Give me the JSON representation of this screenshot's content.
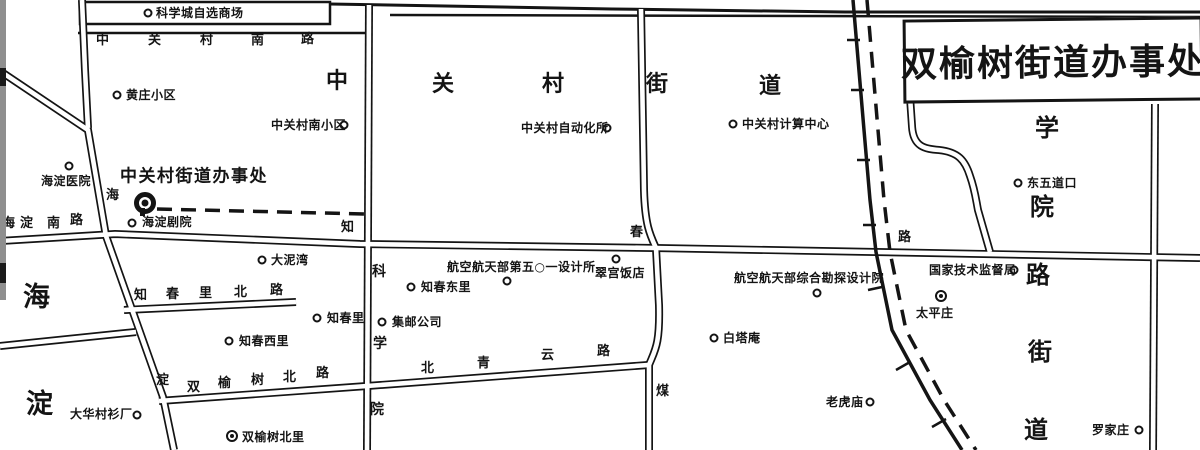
{
  "title_box": {
    "text": "双榆树街道办事处"
  },
  "colors": {
    "ink": "#141414",
    "paper": "#ffffff",
    "edge_strip": "#8f8f8f"
  },
  "block": {
    "name": "kexuecheng-block",
    "x": 80,
    "y": 2,
    "w": 250,
    "h": 22
  },
  "roads": [
    {
      "name": "top-boundary-road",
      "kind": "single",
      "w": 3,
      "d": "M330,4 L612,9 L845,12 L1200,12"
    },
    {
      "name": "top-road-south-edge",
      "kind": "single",
      "w": 2.5,
      "d": "M390,15 L1200,17"
    },
    {
      "name": "zhongguancun-south-road-line",
      "kind": "single",
      "w": 2.5,
      "d": "M78,33 L372,33"
    },
    {
      "name": "haidian-south-zhichun-road",
      "kind": "double",
      "d": "M0,241 L115,234 L360,244 L655,248 L876,252 L1200,258"
    },
    {
      "name": "haidian-road-diagonal",
      "kind": "double",
      "d": "M0,71 L88,130 L106,236 L163,397 L174,450"
    },
    {
      "name": "north-vertical-stub",
      "kind": "double",
      "d": "M82,0 L85,70 L88,128"
    },
    {
      "name": "keyuan-vertical-road",
      "kind": "double",
      "d": "M369,5 L367,450"
    },
    {
      "name": "central-vertical-road",
      "kind": "double",
      "d": "M641,9 L644,190 C645,225 650,235 656,248 L659,305 C660,345 655,350 649,365 L649,450"
    },
    {
      "name": "zhichunli-north-road",
      "kind": "double",
      "d": "M124,310 L296,302"
    },
    {
      "name": "west-stub-road",
      "kind": "double",
      "d": "M0,346 L136,332"
    },
    {
      "name": "shuangyushu-beiqingyun-road",
      "kind": "double",
      "d": "M159,401 L367,386 L648,365"
    },
    {
      "name": "scurve-road",
      "kind": "double",
      "d": "M910,97 L912,126 C913,147 925,149 939,150 C958,152 965,160 970,176 C975,190 976,200 978,210 L990,252"
    },
    {
      "name": "east-vertical-road",
      "kind": "double",
      "d": "M1155,104 L1153,450"
    }
  ],
  "railway": {
    "solid": "M853,0 L864,130 L870,200 L876,252 L892,330 L930,400 L962,450",
    "dashed": "M867,0 L878,130 L884,200 L890,252 L906,330 L944,400 L976,450",
    "ticks": "M847,40 L860,40 M851,90 L864,90 M857,160 L870,160 M863,225 L876,225 M868,290 L882,287 M896,370 L910,362 M932,427 L946,419",
    "dash": "16 10"
  },
  "boundary": {
    "d": "M157,209 L365,214",
    "dash": "15 9"
  },
  "edge_marks": [
    {
      "y": 68,
      "h": 18
    },
    {
      "y": 263,
      "h": 20
    }
  ],
  "area_labels": [
    {
      "name": "zhongguancun-subdistrict-label",
      "size": 22,
      "chars": [
        {
          "c": "中",
          "x": 326,
          "y": 71
        },
        {
          "c": "关",
          "x": 432,
          "y": 74
        },
        {
          "c": "村",
          "x": 542,
          "y": 74
        },
        {
          "c": "街",
          "x": 646,
          "y": 74
        },
        {
          "c": "道",
          "x": 759,
          "y": 76
        }
      ]
    },
    {
      "name": "xueyuanlu-subdistrict-label",
      "size": 24,
      "chars": [
        {
          "c": "学",
          "x": 1035,
          "y": 116
        },
        {
          "c": "院",
          "x": 1030,
          "y": 195
        },
        {
          "c": "路",
          "x": 1026,
          "y": 263
        },
        {
          "c": "街",
          "x": 1028,
          "y": 340
        },
        {
          "c": "道",
          "x": 1024,
          "y": 418
        }
      ]
    },
    {
      "name": "haidian-area-label",
      "size": 27,
      "chars": [
        {
          "c": "海",
          "x": 23,
          "y": 284
        },
        {
          "c": "淀",
          "x": 26,
          "y": 391
        }
      ]
    }
  ],
  "road_labels": [
    {
      "name": "zhongguancun-south-road-label",
      "size": 13,
      "chars": [
        {
          "c": "中",
          "x": 96,
          "y": 34
        },
        {
          "c": "关",
          "x": 148,
          "y": 34
        },
        {
          "c": "村",
          "x": 200,
          "y": 34
        },
        {
          "c": "南",
          "x": 251,
          "y": 34
        },
        {
          "c": "路",
          "x": 301,
          "y": 33
        }
      ]
    },
    {
      "name": "haidian-south-road-label",
      "size": 13,
      "chars": [
        {
          "c": "海",
          "x": 2,
          "y": 217
        },
        {
          "c": "淀",
          "x": 20,
          "y": 217
        },
        {
          "c": "南",
          "x": 47,
          "y": 217
        },
        {
          "c": "路",
          "x": 70,
          "y": 214
        }
      ]
    },
    {
      "name": "zhichun-road-label",
      "size": 13,
      "chars": [
        {
          "c": "知",
          "x": 341,
          "y": 221
        },
        {
          "c": "春",
          "x": 630,
          "y": 226
        },
        {
          "c": "路",
          "x": 898,
          "y": 231
        }
      ]
    },
    {
      "name": "zhichunli-north-road-label",
      "size": 13,
      "chars": [
        {
          "c": "知",
          "x": 134,
          "y": 289
        },
        {
          "c": "春",
          "x": 166,
          "y": 288
        },
        {
          "c": "里",
          "x": 199,
          "y": 287
        },
        {
          "c": "北",
          "x": 234,
          "y": 286
        },
        {
          "c": "路",
          "x": 270,
          "y": 284
        }
      ]
    },
    {
      "name": "shuangyushu-north-road-label",
      "size": 13,
      "chars": [
        {
          "c": "双",
          "x": 187,
          "y": 381
        },
        {
          "c": "榆",
          "x": 218,
          "y": 377
        },
        {
          "c": "树",
          "x": 251,
          "y": 374
        },
        {
          "c": "北",
          "x": 283,
          "y": 371
        },
        {
          "c": "路",
          "x": 316,
          "y": 367
        }
      ]
    },
    {
      "name": "beiqingyun-road-label",
      "size": 13,
      "chars": [
        {
          "c": "北",
          "x": 421,
          "y": 362
        },
        {
          "c": "青",
          "x": 477,
          "y": 357
        },
        {
          "c": "云",
          "x": 541,
          "y": 349
        },
        {
          "c": "路",
          "x": 597,
          "y": 345
        }
      ]
    },
    {
      "name": "keyuan-road-label",
      "size": 14,
      "chars": [
        {
          "c": "科",
          "x": 372,
          "y": 265
        },
        {
          "c": "学",
          "x": 373,
          "y": 337
        },
        {
          "c": "院",
          "x": 370,
          "y": 403
        }
      ]
    },
    {
      "name": "haidian-road-label",
      "size": 13,
      "chars": [
        {
          "c": "海",
          "x": 106,
          "y": 189
        },
        {
          "c": "淀",
          "x": 156,
          "y": 374
        }
      ]
    },
    {
      "name": "mei-road-label",
      "size": 13,
      "chars": [
        {
          "c": "煤",
          "x": 656,
          "y": 385
        }
      ]
    }
  ],
  "pois": [
    {
      "name": "kexuecheng-store",
      "label": "科学城自选商场",
      "lx": 156,
      "ly": 13,
      "mx": 148,
      "my": 13,
      "marker": "ring"
    },
    {
      "name": "huangzhuang-xiaoqu",
      "label": "黄庄小区",
      "lx": 126,
      "ly": 95,
      "mx": 117,
      "my": 95,
      "marker": "ring"
    },
    {
      "name": "zhongguancun-south-xiaoqu",
      "label": "中关村南小区",
      "lx": 271,
      "ly": 125,
      "mx": 344,
      "my": 125,
      "marker": "ring"
    },
    {
      "name": "zhongguancun-automation-institute",
      "label": "中关村自动化所",
      "lx": 521,
      "ly": 128,
      "mx": 607,
      "my": 128,
      "marker": "ring"
    },
    {
      "name": "zhongguancun-computing-center",
      "label": "中关村计算中心",
      "lx": 742,
      "ly": 124,
      "mx": 733,
      "my": 124,
      "marker": "ring"
    },
    {
      "name": "dongwudaokou",
      "label": "东五道口",
      "lx": 1027,
      "ly": 183,
      "mx": 1018,
      "my": 183,
      "marker": "ring"
    },
    {
      "name": "haidian-hospital",
      "label": "海淀医院",
      "lx": 41,
      "ly": 181,
      "mx": 69,
      "my": 166,
      "marker": "ring"
    },
    {
      "name": "zhongguancun-subdistrict-office",
      "label": "中关村街道办事处",
      "lx": 120,
      "ly": 177,
      "mx": 145,
      "my": 203,
      "marker": "office"
    },
    {
      "name": "haidian-theater",
      "label": "海淀剧院",
      "lx": 142,
      "ly": 222,
      "mx": 132,
      "my": 223,
      "marker": "ring"
    },
    {
      "name": "daniwan",
      "label": "大泥湾",
      "lx": 271,
      "ly": 260,
      "mx": 262,
      "my": 260,
      "marker": "ring"
    },
    {
      "name": "zhichun-dongli",
      "label": "知春东里",
      "lx": 421,
      "ly": 287,
      "mx": 411,
      "my": 287,
      "marker": "ring"
    },
    {
      "name": "jiyou-gongsi",
      "label": "集邮公司",
      "lx": 392,
      "ly": 322,
      "mx": 382,
      "my": 322,
      "marker": "ring"
    },
    {
      "name": "zhichunli",
      "label": "知春里",
      "lx": 327,
      "ly": 318,
      "mx": 317,
      "my": 318,
      "marker": "ring"
    },
    {
      "name": "zhichun-xili",
      "label": "知春西里",
      "lx": 239,
      "ly": 341,
      "mx": 229,
      "my": 341,
      "marker": "ring"
    },
    {
      "name": "aerospace-501-design-institute",
      "label": "航空航天部第五○一设计所",
      "lx": 447,
      "ly": 267,
      "mx": 507,
      "my": 281,
      "marker": "ring"
    },
    {
      "name": "cuigong-hotel",
      "label": "翠宫饭店",
      "lx": 595,
      "ly": 273,
      "mx": 616,
      "my": 259,
      "marker": "ring"
    },
    {
      "name": "aerospace-survey-design-institute",
      "label": "航空航天部综合勘探设计院",
      "lx": 734,
      "ly": 278,
      "mx": 817,
      "my": 293,
      "marker": "ring"
    },
    {
      "name": "state-technical-supervision-bureau",
      "label": "国家技术监督局",
      "lx": 929,
      "ly": 270,
      "mx": 1014,
      "my": 270,
      "marker": "ring"
    },
    {
      "name": "taipingzhuang",
      "label": "太平庄",
      "lx": 916,
      "ly": 313,
      "mx": 941,
      "my": 296,
      "marker": "target"
    },
    {
      "name": "baitaan",
      "label": "白塔庵",
      "lx": 723,
      "ly": 338,
      "mx": 714,
      "my": 338,
      "marker": "ring"
    },
    {
      "name": "laohumiao",
      "label": "老虎庙",
      "lx": 826,
      "ly": 402,
      "mx": 870,
      "my": 402,
      "marker": "ring"
    },
    {
      "name": "luojiazhuang",
      "label": "罗家庄",
      "lx": 1092,
      "ly": 430,
      "mx": 1139,
      "my": 430,
      "marker": "ring"
    },
    {
      "name": "dahua-shirt-factory",
      "label": "大华村衫厂",
      "lx": 70,
      "ly": 414,
      "mx": 137,
      "my": 415,
      "marker": "ring"
    },
    {
      "name": "shuangyushu-beili",
      "label": "双榆树北里",
      "lx": 242,
      "ly": 437,
      "mx": 232,
      "my": 436,
      "marker": "target"
    }
  ]
}
